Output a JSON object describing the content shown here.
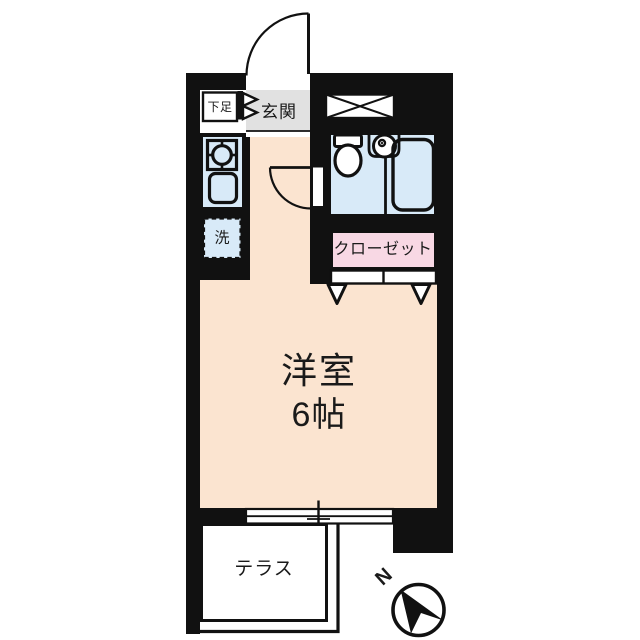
{
  "plan": {
    "type": "japanese-apartment-floor-plan",
    "labels": {
      "shoe_cabinet": "下足",
      "entrance": "玄関",
      "washer_space": "洗",
      "closet": "クローゼット",
      "main_room_name": "洋室",
      "main_room_size": "6帖",
      "terrace": "テラス",
      "compass_north": "N"
    },
    "colors": {
      "wall": "#111111",
      "room_fill": "#FBE4D0",
      "wet_area_fill": "#D8EAF8",
      "closet_fill": "#F8D8E4",
      "entrance_fill": "#E1E1E1",
      "terrace_fill": "#FFFFFF",
      "line": "#111111"
    }
  }
}
